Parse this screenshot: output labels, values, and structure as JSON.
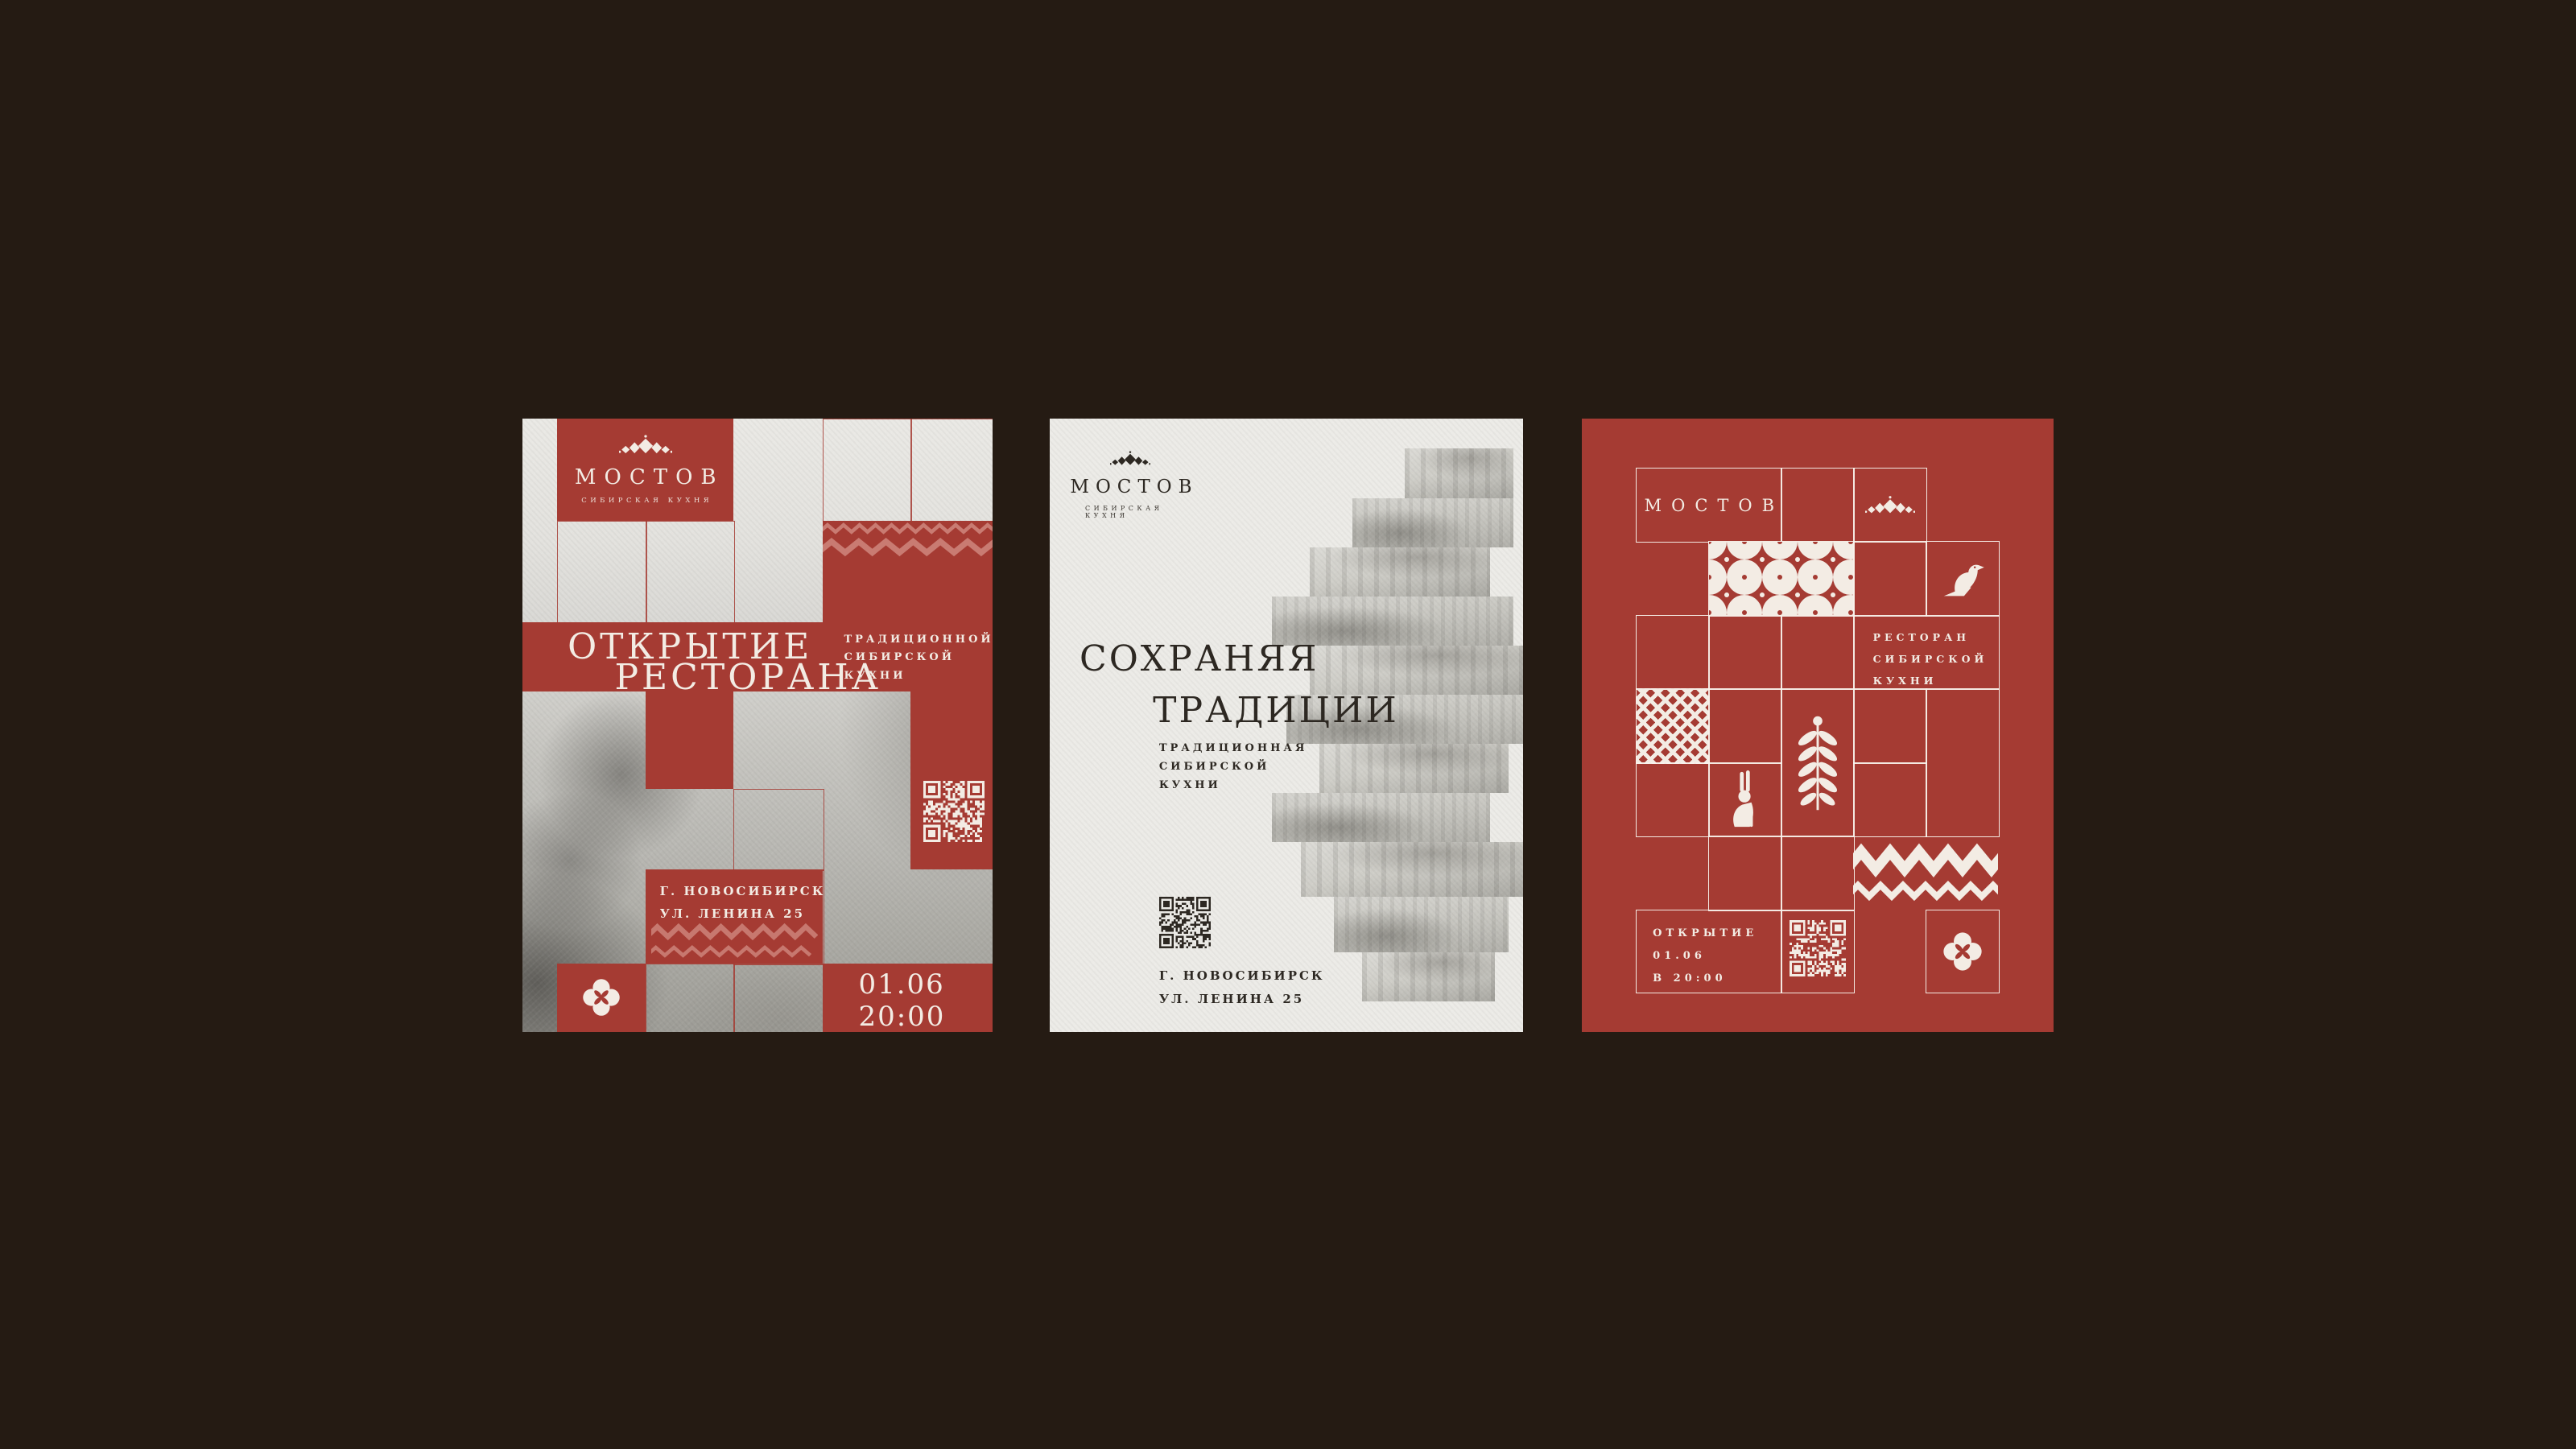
{
  "stage": {
    "background": "#251b13"
  },
  "colors": {
    "brick_red": "#a53b33",
    "paper": "#ecebe7",
    "ink": "#2d2822",
    "cream": "#f3ece4",
    "ornament_light": "rgba(255,221,210,0.40)"
  },
  "icons": {
    "crown": "crown-ornament-icon",
    "bird": "bird-icon",
    "hare": "hare-icon",
    "wheat": "wheat-branch-icon",
    "clover": "clover-flower-icon",
    "rosette": "rosette-pattern",
    "pixel": "cross-stitch-pattern",
    "zigzag": "zigzag-ornament",
    "qr": "qr-code"
  },
  "poster_left": {
    "logo_name": "МОСТОВ",
    "logo_tagline": "СИБИРСКАЯ КУХНЯ",
    "title_line1": "ОТКРЫТИЕ",
    "title_line2": "РЕСТОРАНА",
    "subtitle_line1": "ТРАДИЦИОННОЙ",
    "subtitle_line2": "СИБИРСКОЙ",
    "subtitle_line3": "КУХНИ",
    "address_line1": "Г. НОВОСИБИРСК",
    "address_line2": "УЛ. ЛЕНИНА 25",
    "date": "01.06",
    "time": "20:00"
  },
  "poster_middle": {
    "logo_name": "МОСТОВ",
    "logo_tagline": "СИБИРСКАЯ КУХНЯ",
    "title_line1": "СОХРАНЯЯ",
    "title_line2": "ТРАДИЦИИ",
    "subtitle_line1": "ТРАДИЦИОННАЯ",
    "subtitle_line2": "СИБИРСКОЙ",
    "subtitle_line3": "КУХНИ",
    "address_line1": "Г. НОВОСИБИРСК",
    "address_line2": "УЛ. ЛЕНИНА 25"
  },
  "poster_right": {
    "logo_name": "МОСТОВ",
    "tagline_line1": "РЕСТОРАН",
    "tagline_line2": "СИБИРСКОЙ",
    "tagline_line3": "КУХНИ",
    "opening_line1": "ОТКРЫТИЕ",
    "opening_line2": "01.06",
    "opening_line3": "В 20:00"
  }
}
